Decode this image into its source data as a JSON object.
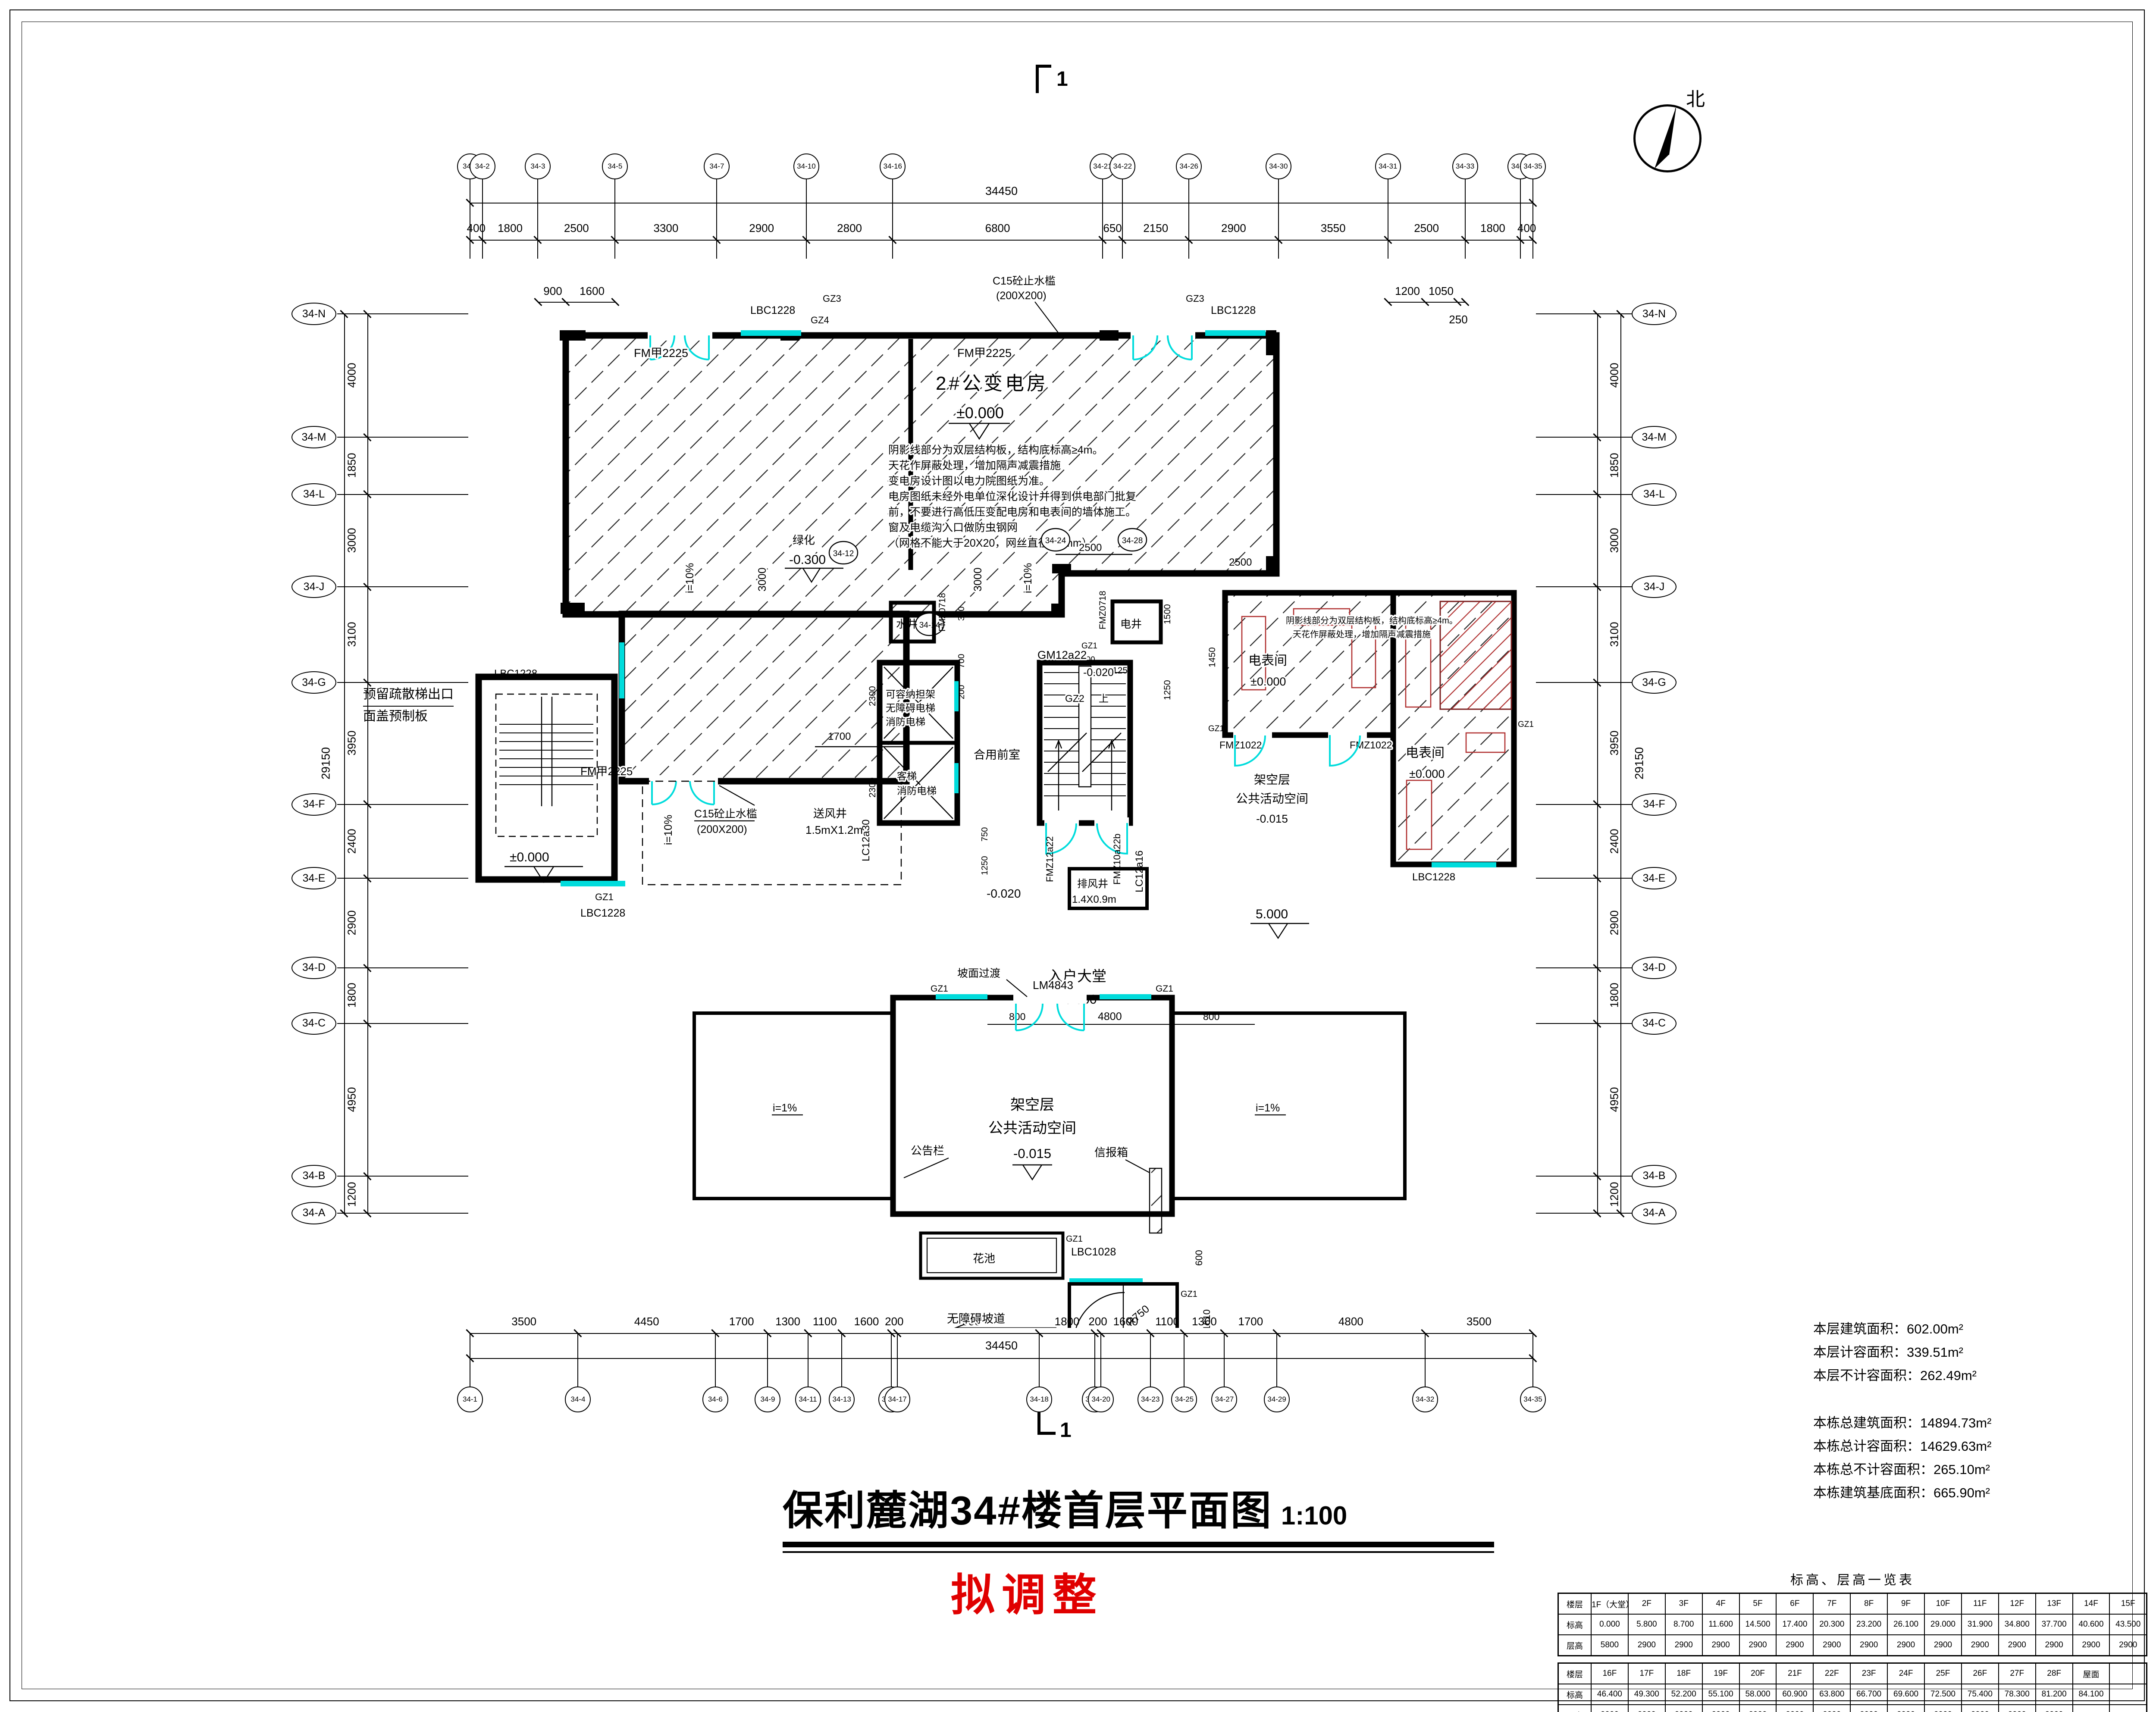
{
  "sheet": {
    "title": "保利麓湖34#楼首层平面图",
    "scale": "1:100",
    "revision_note": "拟调整",
    "north_label": "北",
    "section_mark_top": "1",
    "section_mark_bottom": "1"
  },
  "grids": {
    "top": {
      "labels": [
        "34-1",
        "34-2",
        "34-3",
        "34-5",
        "34-7",
        "34-10",
        "34-16",
        "34-21",
        "34-22",
        "34-26",
        "34-30",
        "34-31",
        "34-33",
        "34-34",
        "34-35"
      ],
      "dims": [
        "400",
        "1800",
        "2500",
        "3300",
        "2900",
        "2800",
        "6800",
        "650",
        "2150",
        "2900",
        "3550",
        "2500",
        "1800",
        "400"
      ],
      "total": "34450",
      "sub_left": [
        "900",
        "1600"
      ],
      "sub_right": [
        "1200",
        "1050",
        "250"
      ]
    },
    "bottom": {
      "labels": [
        "34-1",
        "34-4",
        "34-6",
        "34-9",
        "34-11",
        "34-13",
        "34-15",
        "34-17",
        "34-18",
        "34-19",
        "34-20",
        "34-23",
        "34-25",
        "34-27",
        "34-29",
        "34-32",
        "34-35"
      ],
      "dims": [
        "3500",
        "4450",
        "1700",
        "1300",
        "1100",
        "1600",
        "200",
        "4600",
        "1800",
        "200",
        "1600",
        "1100",
        "1300",
        "1700",
        "4800",
        "3500"
      ],
      "total": "34450"
    },
    "left": {
      "labels": [
        "34-N",
        "34-M",
        "34-L",
        "34-J",
        "34-G",
        "34-F",
        "34-E",
        "34-D",
        "34-C",
        "34-B",
        "34-A"
      ],
      "dims": [
        "4000",
        "1850",
        "3000",
        "3100",
        "3950",
        "2400",
        "2900",
        "1800",
        "4950",
        "1200"
      ],
      "total": "29150"
    },
    "right": {
      "labels": [
        "34-N",
        "34-M",
        "34-L",
        "34-J",
        "34-G",
        "34-F",
        "34-E",
        "34-D",
        "34-C",
        "34-B",
        "34-A"
      ],
      "dims": [
        "4000",
        "1850",
        "3000",
        "3100",
        "3950",
        "2400",
        "2900",
        "1800",
        "4950",
        "1200"
      ],
      "total": "29150"
    }
  },
  "stats": {
    "current": [
      "本层建筑面积：602.00m²",
      "本层计容面积：339.51m²",
      "本层不计容面积：262.49m²"
    ],
    "building": [
      "本栋总建筑面积：14894.73m²",
      "本栋总计容面积：14629.63m²",
      "本栋总不计容面积：265.10m²",
      "本栋建筑基底面积：665.90m²"
    ]
  },
  "table": {
    "title": "标高、层高一览表",
    "bands": [
      {
        "rows": [
          [
            "楼层",
            "1F（大堂）",
            "2F",
            "3F",
            "4F",
            "5F",
            "6F",
            "7F",
            "8F",
            "9F",
            "10F",
            "11F",
            "12F",
            "13F",
            "14F",
            "15F"
          ],
          [
            "标高",
            "0.000",
            "5.800",
            "8.700",
            "11.600",
            "14.500",
            "17.400",
            "20.300",
            "23.200",
            "26.100",
            "29.000",
            "31.900",
            "34.800",
            "37.700",
            "40.600",
            "43.500"
          ],
          [
            "层高",
            "5800",
            "2900",
            "2900",
            "2900",
            "2900",
            "2900",
            "2900",
            "2900",
            "2900",
            "2900",
            "2900",
            "2900",
            "2900",
            "2900",
            "2900"
          ]
        ]
      },
      {
        "rows": [
          [
            "楼层",
            "16F",
            "17F",
            "18F",
            "19F",
            "20F",
            "21F",
            "22F",
            "23F",
            "24F",
            "25F",
            "26F",
            "27F",
            "28F",
            "屋面",
            ""
          ],
          [
            "标高",
            "46.400",
            "49.300",
            "52.200",
            "55.100",
            "58.000",
            "60.900",
            "63.800",
            "66.700",
            "69.600",
            "72.500",
            "75.400",
            "78.300",
            "81.200",
            "84.100",
            ""
          ],
          [
            "层高",
            "2900",
            "2900",
            "2900",
            "2900",
            "2900",
            "2900",
            "2900",
            "2900",
            "2900",
            "2900",
            "2900",
            "2900",
            "2900",
            "",
            ""
          ]
        ]
      }
    ]
  },
  "plan": {
    "transformer": {
      "name": "2#公变电房",
      "level": "±0.000"
    },
    "notes": [
      "阴影线部分为双层结构板，结构底标高≥4m。",
      "天花作屏蔽处理，增加隔声减震措施",
      "变电房设计图以电力院图纸为准。",
      "电房图纸未经外电单位深化设计并得到供电部门批复",
      "前，不要进行高低压变配电房和电表间的墙体施工。",
      "窗及电缆沟入口做防虫钢网",
      "（网格不能大于20X20，网丝直径1.2mm）"
    ],
    "meter_note": [
      "阴影线部分为双层结构板，结构底标高≥4m。",
      "天花作屏蔽处理，增加隔声减震措施"
    ],
    "rooms": {
      "meter_a": {
        "name": "电表间",
        "level": "±0.000"
      },
      "meter_b": {
        "name": "电表间",
        "level": "±0.000"
      },
      "stilt": {
        "line1": "架空层",
        "line2": "公共活动空间"
      },
      "lobby": {
        "name": "入户大堂",
        "level": "±0.000"
      },
      "shared_front": "合用前室",
      "elevator_a": [
        "可容纳担架",
        "无障碍电梯",
        "消防电梯"
      ],
      "elevator_b": [
        "客梯",
        "消防电梯"
      ],
      "water_shaft": "水井",
      "elec_shaft": "电井",
      "supply_shaft": {
        "name": "送风井",
        "size": "1.5mX1.2m"
      },
      "exhaust_shaft": {
        "name": "排风井",
        "size": "1.4X0.9m"
      },
      "greening": {
        "name": "绿化",
        "level": "-0.300"
      }
    },
    "stair_exit": {
      "line1": "预留疏散梯出口",
      "line2": "面盖预制板"
    },
    "stair": {
      "door": "GM12a22",
      "gz": "GZ2"
    },
    "ramp": {
      "name": "无障碍坡道",
      "radius": "R750",
      "slope": "i=1:12",
      "curb": "砼挡台",
      "curb_size": "100X100"
    },
    "site": {
      "flower_bed": "花池",
      "notice": "公告栏",
      "mailbox": "信报箱",
      "slope_trans": "坡面过渡"
    },
    "levels": {
      "pm0": "±0.000",
      "m020": "-0.020",
      "m015": "-0.015",
      "m030": "-0.300",
      "p5": "5.000"
    },
    "tags": {
      "fm2225": "FM甲2225",
      "fmz1022": "FMZ1022",
      "fmz0718": "FMZ0718",
      "fmz12a22": "FMZ12a22",
      "fmz10a22b": "FMZ10a22b",
      "lm4843": "LM4843",
      "lbc1228": "LBC1228",
      "lbc1028": "LBC1028",
      "lc12a30": "LC12a30",
      "lc12a16": "LC12a16",
      "gz1": "GZ1",
      "gz3": "GZ3",
      "gz4": "GZ4",
      "up": "上"
    },
    "waterstop": {
      "line1": "C15砼止水槛",
      "line2": "(200X200)"
    },
    "slopes": {
      "i1": "i=1%",
      "i10": "i=10%"
    },
    "dims": {
      "d300": "300",
      "d700": "700",
      "d200": "200",
      "d100": "100",
      "d1250": "1250",
      "d1500": "1500",
      "d2300": "2300",
      "d750": "750",
      "d800": "800",
      "d4800": "4800",
      "d1900": "1900",
      "d1400": "1400",
      "d600": "600",
      "d1610": "1610",
      "d1510": "1510",
      "d2500": "2500",
      "d1700": "1700",
      "d1450": "1450",
      "d3000": "3000",
      "size_exhaust": "1.4X0.9m",
      "size_supply": "1.5mX1.2m"
    },
    "inner_bubbles": [
      "34-12",
      "34-14",
      "34-24",
      "34-28"
    ]
  }
}
